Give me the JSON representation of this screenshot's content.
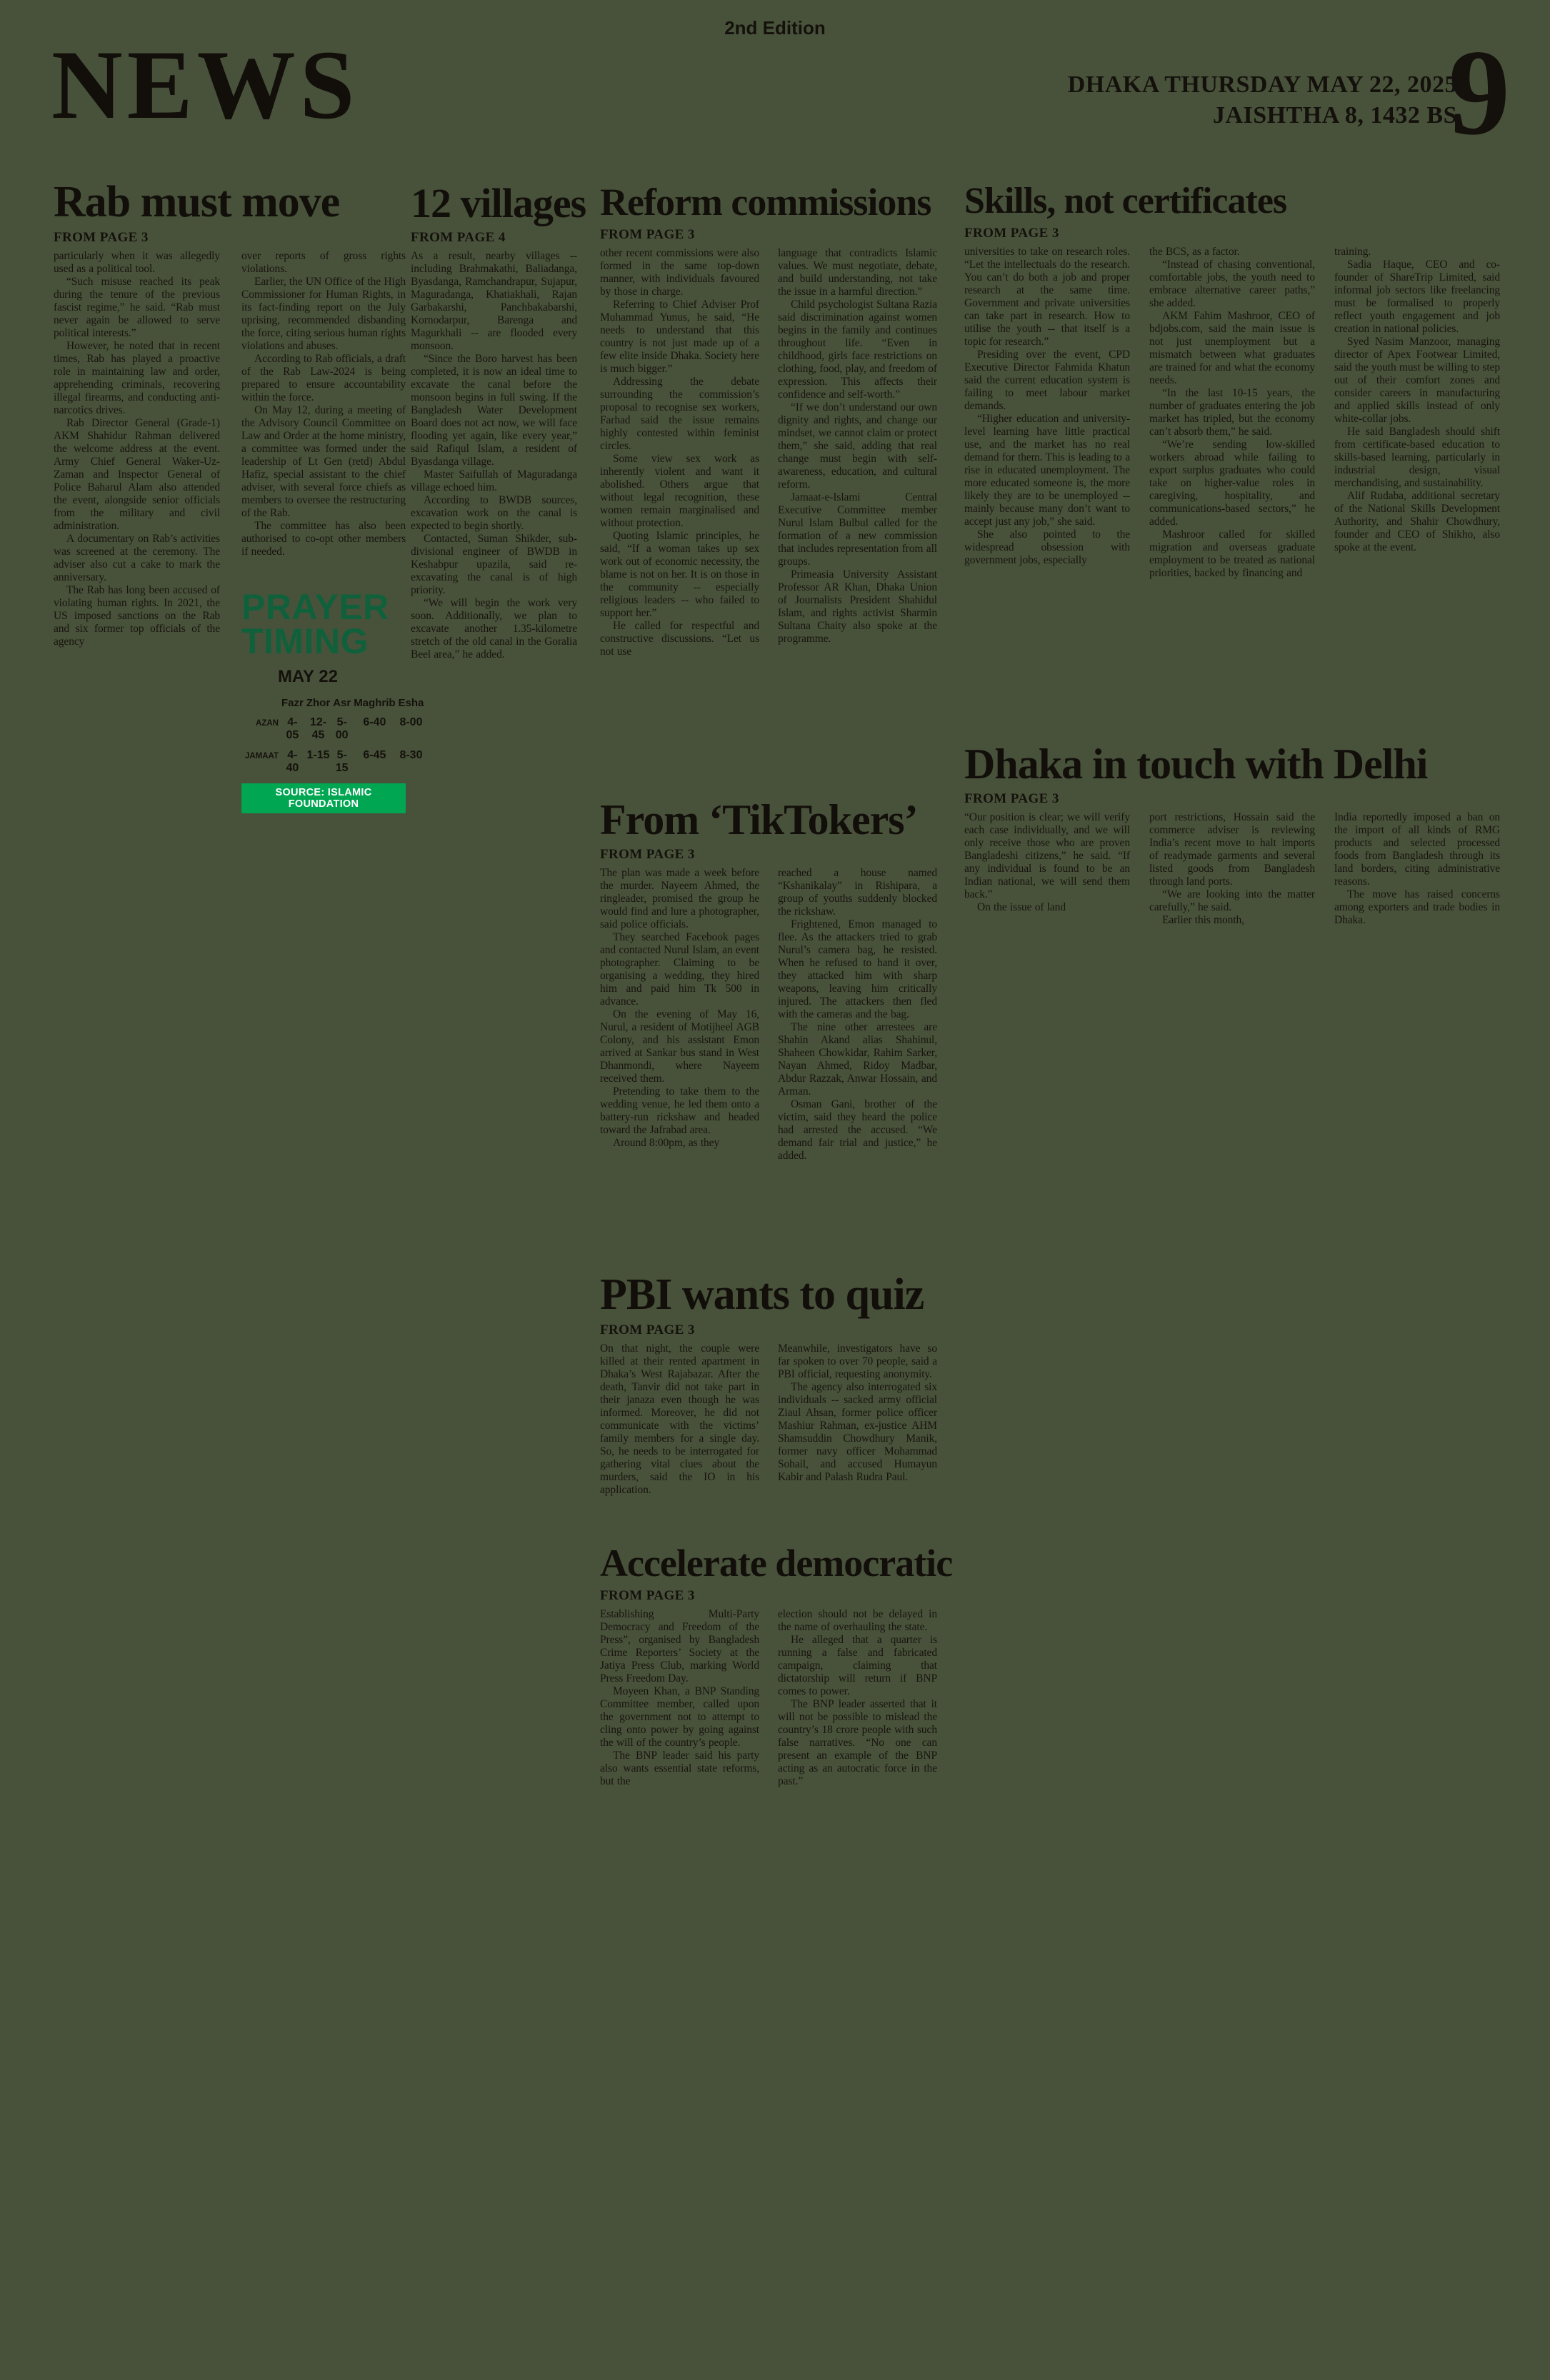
{
  "page": {
    "edition": "2nd Edition",
    "section": "NEWS",
    "dateline_line1": "DHAKA THURSDAY MAY 22, 2025",
    "dateline_line2": "JAISHTHA 8, 1432 BS",
    "page_number": "9"
  },
  "colors": {
    "background": "#48523a",
    "ink": "#17130e",
    "prayer_heading_green": "#10603c",
    "source_bar_green": "#00a651",
    "source_bar_text": "#ffffff"
  },
  "articles": {
    "rab": {
      "title": "Rab must move",
      "from": "FROM PAGE 3",
      "cols": [
        "particularly when it was allegedly used as a political tool.\n“Such misuse reached its peak during the tenure of the previous fascist regime,” he said. “Rab must never again be allowed to serve political interests.”\nHowever, he noted that in recent times, Rab has played a proactive role in maintaining law and order, apprehending criminals, recovering illegal firearms, and conducting anti-narcotics drives.\nRab Director General (Grade-1) AKM Shahidur Rahman delivered the welcome address at the event. Army Chief General Waker-Uz-Zaman and Inspector General of Police Baharul Alam also attended the event, alongside senior officials from the military and civil administration.\nA documentary on Rab’s activities was screened at the ceremony. The adviser also cut a cake to mark the anniversary.\nThe Rab has long been accused of violating human rights. In 2021, the US imposed sanctions on the Rab and six former top officials of the agency",
        "over reports of gross rights violations.\nEarlier, the UN Office of the High Commissioner for Human Rights, in its fact-finding report on the July uprising, recommended disbanding the force, citing serious human rights violations and abuses.\nAccording to Rab officials, a draft of the Rab Law-2024 is being prepared to ensure accountability within the force.\nOn May 12, during a meeting of the Advisory Council Committee on Law and Order at the home ministry, a committee was formed under the leadership of Lt Gen (retd) Abdul Hafiz, special assistant to the chief adviser, with several force chiefs as members to oversee the restructuring of the Rab.\nThe committee has also been authorised to co-opt other members if needed."
      ]
    },
    "villages": {
      "title": "12 villages",
      "from": "FROM PAGE 4",
      "cols": [
        "As a result, nearby villages -- including Brahmakathi, Baliadanga, Byasdanga, Ramchandrapur, Sujapur, Maguradanga, Khatiakhali, Rajan Garbakarshi, Panchbakabarshi, Kornodarpur, Barenga and Magurkhali -- are flooded every monsoon.\n“Since the Boro harvest has been completed, it is now an ideal time to excavate the canal before the monsoon begins in full swing. If the Bangladesh Water Development Board does not act now, we will face flooding yet again, like every year,” said Rafiqul Islam, a resident of Byasdanga village.\nMaster Saifullah of Maguradanga village echoed him.\nAccording to BWDB sources, excavation work on the canal is expected to begin shortly.\nContacted, Suman Shikder, sub-divisional engineer of BWDB in Keshabpur upazila, said re-excavating the canal is of high priority.\n“We will begin the work very soon. Additionally, we plan to excavate another 1.35-kilometre stretch of the old canal in the Goralia Beel area,” he added."
      ]
    },
    "reform": {
      "title": "Reform commissions",
      "from": "FROM PAGE 3",
      "cols": [
        "other recent commissions were also formed in the same top-down manner, with individuals favoured by those in charge.\nReferring to Chief Adviser Prof Muhammad Yunus, he said, “He needs to understand that this country is not just made up of a few elite inside Dhaka. Society here is much bigger.”\nAddressing the debate surrounding the commission’s proposal to recognise sex workers, Farhad said the issue remains highly contested within feminist circles.\nSome view sex work as inherently violent and want it abolished. Others argue that without legal recognition, these women remain marginalised and without protection.\nQuoting Islamic principles, he said, “If a woman takes up sex work out of economic necessity, the blame is not on her. It is on those in the community -- especially religious leaders -- who failed to support her.”\nHe called for respectful and constructive discussions. “Let us not use",
        "language that contradicts Islamic values. We must negotiate, debate, and build understanding, not take the issue in a harmful direction.”\nChild psychologist Sultana Razia said discrimination against women begins in the family and continues throughout life. “Even in childhood, girls face restrictions on clothing, food, play, and freedom of expression. This affects their confidence and self-worth.”\n“If we don’t understand our own dignity and rights, and change our mindset, we cannot claim or protect them,” she said, adding that real change must begin with self-awareness, education, and cultural reform.\nJamaat-e-Islami Central Executive Committee member Nurul Islam Bulbul called for the formation of a new commission that includes representation from all groups.\nPrimeasia University Assistant Professor AR Khan, Dhaka Union of Journalists President Shahidul Islam, and rights activist Sharmin Sultana Chaity also spoke at the programme."
      ]
    },
    "skills": {
      "title": "Skills, not certificates",
      "from": "FROM PAGE 3",
      "cols": [
        "universities to take on research roles. “Let the intellectuals do the research. You can’t do both a job and proper research at the same time. Government and private universities can take part in research. How to utilise the youth -- that itself is a topic for research.”\nPresiding over the event, CPD Executive Director Fahmida Khatun said the current education system is failing to meet labour market demands.\n“Higher education and university-level learning have little practical use, and the market has no real demand for them. This is leading to a rise in educated unemployment. The more educated someone is, the more likely they are to be unemployed -- mainly because many don’t want to accept just any job,” she said.\nShe also pointed to the widespread obsession with government jobs, especially",
        "the BCS, as a factor.\n“Instead of chasing conventional, comfortable jobs, the youth need to embrace alternative career paths,” she added.\nAKM Fahim Mashroor, CEO of bdjobs.com, said the main issue is not just unemployment but a mismatch between what graduates are trained for and what the economy needs.\n“In the last 10-15 years, the number of graduates entering the job market has tripled, but the economy can’t absorb them,” he said.\n“We’re sending low-skilled workers abroad while failing to export surplus graduates who could take on higher-value roles in caregiving, hospitality, and communications-based sectors,” he added.\nMashroor called for skilled migration and overseas graduate employment to be treated as national priorities, backed by financing and",
        "training.\nSadia Haque, CEO and co-founder of ShareTrip Limited, said informal job sectors like freelancing must be formalised to properly reflect youth engagement and job creation in national policies.\nSyed Nasim Manzoor, managing director of Apex Footwear Limited, said the youth must be willing to step out of their comfort zones and consider careers in manufacturing and applied skills instead of only white-collar jobs.\nHe said Bangladesh should shift from certificate-based education to skills-based learning, particularly in industrial design, visual merchandising, and sustainability.\nAlif Rudaba, additional secretary of the National Skills Development Authority, and Shahir Chowdhury, founder and CEO of Shikho, also spoke at the event."
      ]
    },
    "dhaka": {
      "title": "Dhaka in touch with Delhi",
      "from": "FROM PAGE 3",
      "cols": [
        "“Our position is clear; we will verify each case individually, and we will only receive those who are proven Bangladeshi citizens,” he said. “If any individual is found to be an Indian national, we will send them back.”\nOn the issue of land",
        "port restrictions, Hossain said the commerce adviser is reviewing India’s recent move to halt imports of readymade garments and several listed goods from Bangladesh through land ports.\n“We are looking into the matter carefully,” he said.\nEarlier this month,",
        "India reportedly imposed a ban on the import of all kinds of RMG products and selected processed foods from Bangladesh through its land borders, citing administrative reasons.\nThe move has raised concerns among exporters and trade bodies in Dhaka."
      ]
    },
    "tiktokers": {
      "title": "From ‘TikTokers’",
      "from": "FROM PAGE 3",
      "cols": [
        "The plan was made a week before the murder. Nayeem Ahmed, the ringleader, promised the group he would find and lure a photographer, said police officials.\nThey searched Facebook pages and contacted Nurul Islam, an event photographer. Claiming to be organising a wedding, they hired him and paid him Tk 500 in advance.\nOn the evening of May 16, Nurul, a resident of Motijheel AGB Colony, and his assistant Emon arrived at Sankar bus stand in West Dhanmondi, where Nayeem received them.\nPretending to take them to the wedding venue, he led them onto a battery-run rickshaw and headed toward the Jafrabad area.\nAround 8:00pm, as they",
        "reached a house named “Kshanikalay” in Rishipara, a group of youths suddenly blocked the rickshaw.\nFrightened, Emon managed to flee. As the attackers tried to grab Nurul’s camera bag, he resisted. When he refused to hand it over, they attacked him with sharp weapons, leaving him critically injured. The attackers then fled with the cameras and the bag.\nThe nine other arrestees are Shahin Akand alias Shahinul, Shaheen Chowkidar, Rahim Sarker, Nayan Ahmed, Ridoy Madbar, Abdur Razzak, Anwar Hossain, and Arman.\nOsman Gani, brother of the victim, said they heard the police had arrested the accused. “We demand fair trial and justice,” he added."
      ]
    },
    "pbi": {
      "title": "PBI wants to quiz",
      "from": "FROM PAGE 3",
      "cols": [
        "On that night, the couple were killed at their rented apartment in Dhaka’s West Rajabazar. After the death, Tanvir did not take part in their janaza even though he was informed. Moreover, he did not communicate with the victims’ family members for a single day. So, he needs to be interrogated for gathering vital clues about the murders, said the IO in his application.",
        "Meanwhile, investigators have so far spoken to over 70 people, said a PBI official, requesting anonymity.\nThe agency also interrogated six individuals -- sacked army official Ziaul Ahsan, former police officer Mashiur Rahman, ex-justice AHM Shamsuddin Chowdhury Manik, former navy officer Mohammad Sohail, and accused Humayun Kabir and Palash Rudra Paul."
      ]
    },
    "accelerate": {
      "title": "Accelerate democratic",
      "from": "FROM PAGE 3",
      "cols": [
        "Establishing Multi-Party Democracy and Freedom of the Press”, organised by Bangladesh Crime Reporters’ Society at the Jatiya Press Club, marking World Press Freedom Day.\nMoyeen Khan, a BNP Standing Committee member, called upon the government not to attempt to cling onto power by going against the will of the country’s people.\nThe BNP leader said his party also wants essential state reforms, but the",
        "election should not be delayed in the name of overhauling the state.\nHe alleged that a quarter is running a false and fabricated campaign, claiming that dictatorship will return if BNP comes to power.\nThe BNP leader asserted that it will not be possible to mislead the country’s 18 crore people with such false narratives. “No one can present an example of the BNP acting as an autocratic force in the past.”"
      ]
    }
  },
  "prayer": {
    "title_line1": "PRAYER",
    "title_line2": "TIMING",
    "date": "MAY 22",
    "columns": [
      "Fazr",
      "Zhor",
      "Asr",
      "Maghrib",
      "Esha"
    ],
    "rows": [
      {
        "label": "AZAN",
        "times": [
          "4-05",
          "12-45",
          "5-00",
          "6-40",
          "8-00"
        ]
      },
      {
        "label": "JAMAAT",
        "times": [
          "4-40",
          "1-15",
          "5-15",
          "6-45",
          "8-30"
        ]
      }
    ],
    "source": "SOURCE: ISLAMIC FOUNDATION"
  }
}
